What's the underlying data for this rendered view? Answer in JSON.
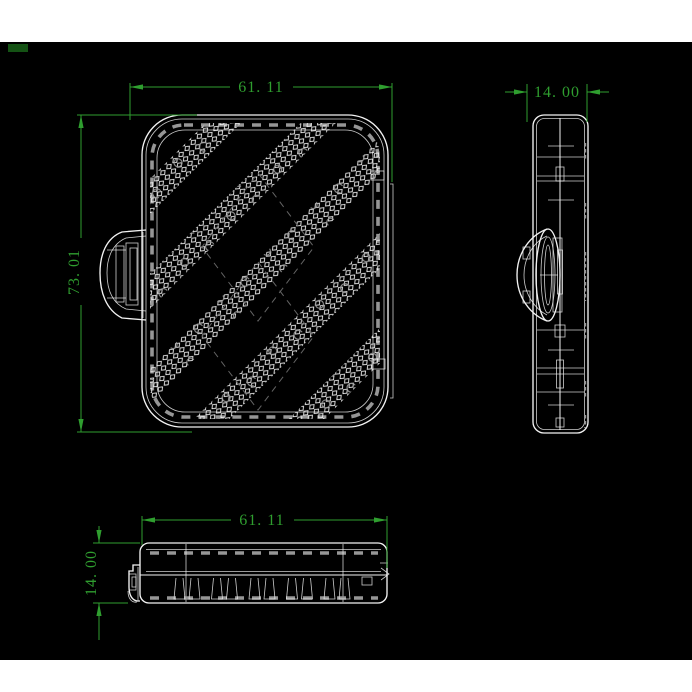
{
  "colors": {
    "page": "#ffffff",
    "canvas": "#000000",
    "line": "#f2f2f2",
    "hidden": "#969696",
    "dim": "#2f9e2f",
    "chip": "#145214"
  },
  "dimensions": {
    "front_width": "61. 11",
    "front_height": "73. 01",
    "side_width": "14. 00",
    "bottom_width": "61. 11",
    "bottom_height": "14. 00"
  }
}
